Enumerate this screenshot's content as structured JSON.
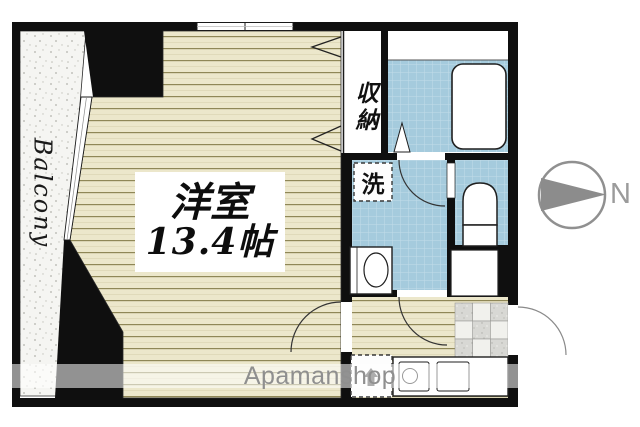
{
  "floorplan": {
    "balcony_label": "Balcony",
    "room": {
      "name": "洋室",
      "size": "13.4帖"
    },
    "closet_label": "収納",
    "washer_label": "洗",
    "compass_label": "N",
    "watermark": "Apamanshop"
  },
  "colors": {
    "wall": "#0f0f0f",
    "wood_floor": "#ece7cb",
    "wood_line": "#8f8757",
    "water_blue": "#a5cbdd",
    "balcony_bg": "#f5f5f2",
    "entrance_tile": "#d8d8d4",
    "compass_gray": "#8c8c8c",
    "watermark_text": "#8f8f8f"
  },
  "icons": {
    "compass_needle": "right-pointing-triangle",
    "appliance_marker": "up-arrow",
    "door_swings": "quarter-arc"
  }
}
